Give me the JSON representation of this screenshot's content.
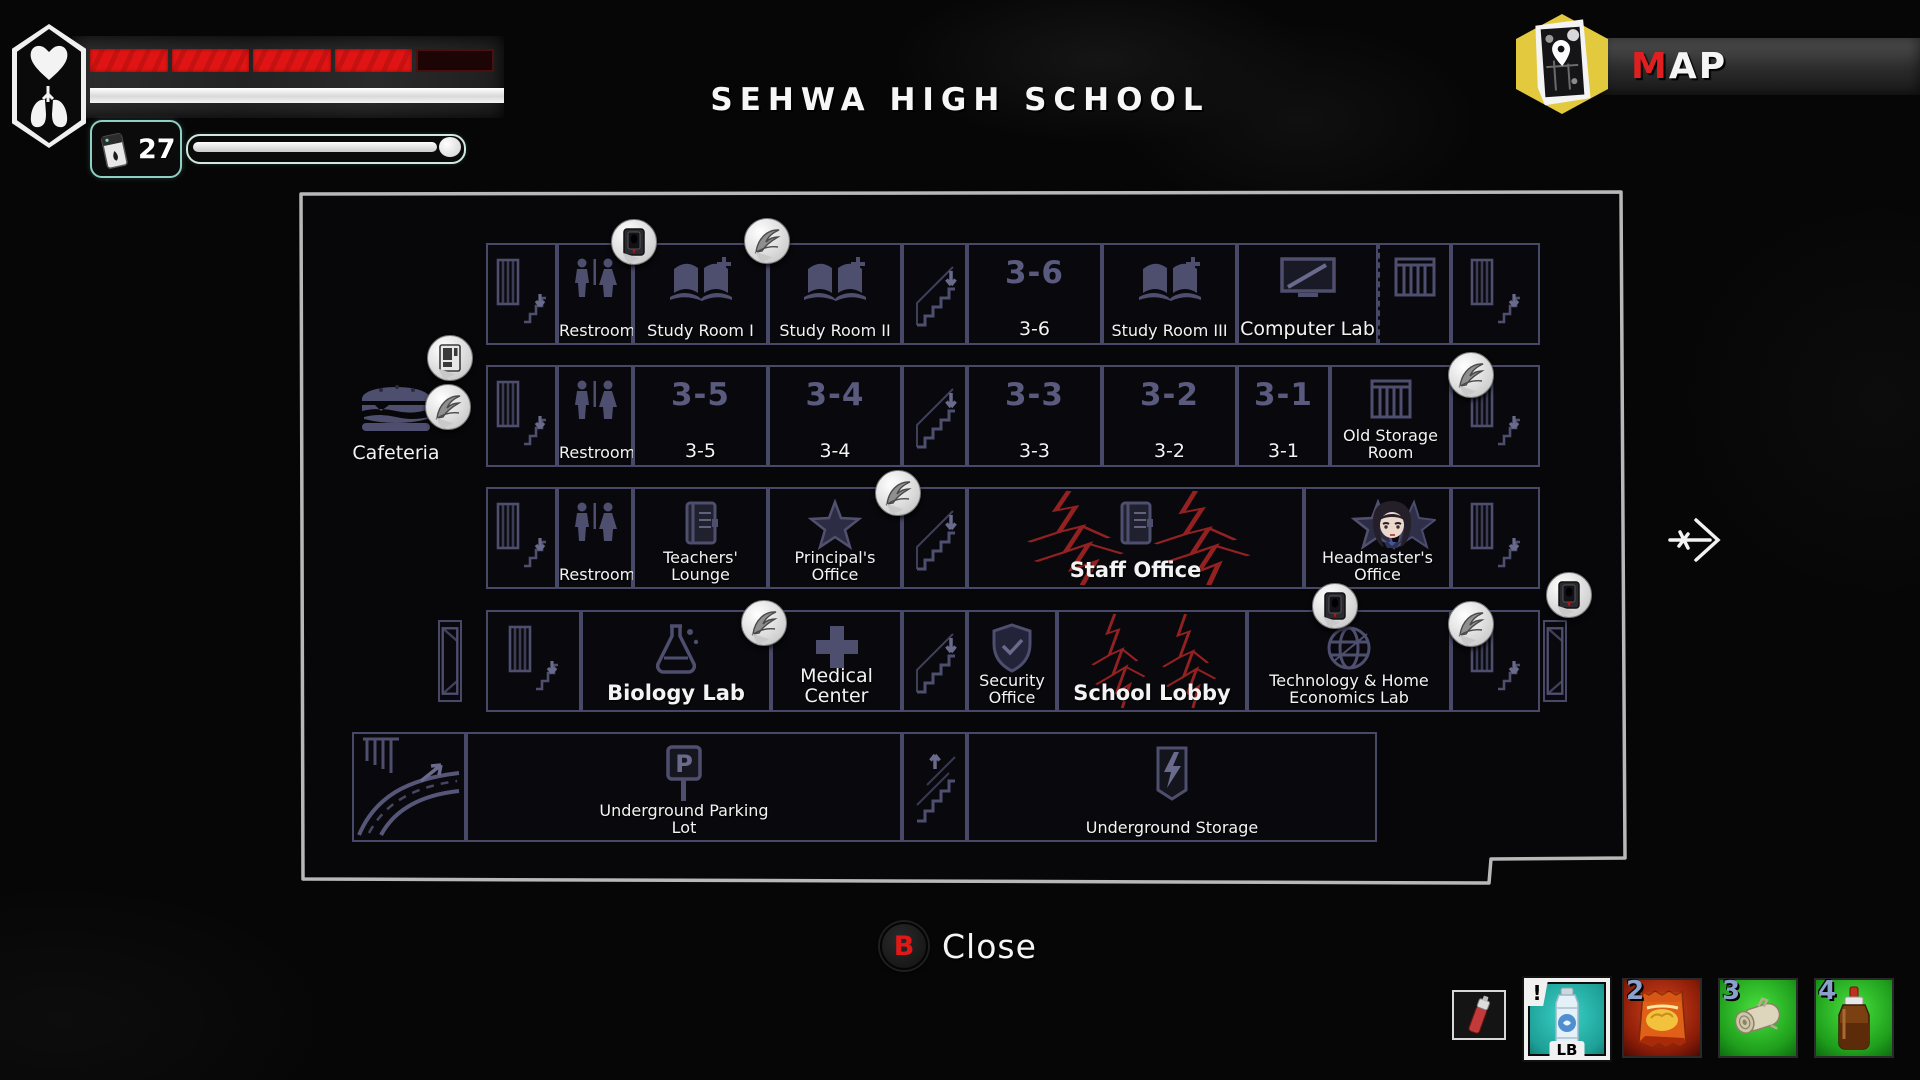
{
  "colors": {
    "health_red": "#e01414",
    "accent_red": "#e02020",
    "room_outline": "#484868",
    "icon_ink": "#4e4e6e",
    "crack_red": "#9c2323",
    "hex_yellow": "#e3c93e",
    "selected_teal": "#2fc4ba"
  },
  "hud": {
    "health": {
      "segments_total": 5,
      "segments_filled": 4
    },
    "stamina_full": true,
    "lighter_count": "27",
    "icons": [
      "heart-icon",
      "lungs-icon",
      "lighter-icon",
      "match-meter"
    ]
  },
  "header": {
    "title": "SEHWA HIGH SCHOOL",
    "map_badge": {
      "accent": "M",
      "rest": "AP",
      "icon": "map-icon"
    }
  },
  "map": {
    "floors": [
      {
        "name": "floor-top",
        "y": 243,
        "h": 102,
        "rooms": [
          {
            "id": "stairwell-nw",
            "icon": "door-stairs",
            "x": 486,
            "w": 71
          },
          {
            "id": "restroom-3f",
            "icon": "restroom",
            "label": "Restroom",
            "x": 557,
            "w": 76
          },
          {
            "id": "study-room-1",
            "icon": "book-plus",
            "label": "Study Room I",
            "x": 633,
            "w": 135
          },
          {
            "id": "study-room-2",
            "icon": "book-plus",
            "label": "Study Room II",
            "x": 768,
            "w": 134
          },
          {
            "id": "stairs-mid-top",
            "icon": "stairs-down",
            "x": 902,
            "w": 65
          },
          {
            "id": "classroom-3-6",
            "number": "3-6",
            "label": "3-6",
            "label_size": "md",
            "x": 967,
            "w": 135
          },
          {
            "id": "study-room-3",
            "icon": "book-plus",
            "label": "Study Room III",
            "x": 1102,
            "w": 135
          },
          {
            "id": "computer-lab",
            "icon": "monitor",
            "label": "Computer Lab",
            "label_size": "md",
            "x": 1237,
            "w": 141
          },
          {
            "id": "shelf-nook",
            "icon": "shelf",
            "dashed": true,
            "x": 1378,
            "w": 73
          },
          {
            "id": "stairwell-ne",
            "icon": "door-stairs",
            "x": 1451,
            "w": 89
          }
        ]
      },
      {
        "name": "floor-2",
        "y": 365,
        "h": 102,
        "rooms": [
          {
            "id": "cafeteria",
            "icon": "burger",
            "label": "Cafeteria",
            "label_size": "md",
            "outside": true,
            "x": 332,
            "w": 128
          },
          {
            "id": "stairwell-w2",
            "icon": "door-stairs",
            "x": 486,
            "w": 71
          },
          {
            "id": "restroom-2f",
            "icon": "restroom",
            "label": "Restroom",
            "x": 557,
            "w": 76
          },
          {
            "id": "classroom-3-5",
            "number": "3-5",
            "label": "3-5",
            "label_size": "md",
            "x": 633,
            "w": 135
          },
          {
            "id": "classroom-3-4",
            "number": "3-4",
            "label": "3-4",
            "label_size": "md",
            "x": 768,
            "w": 134
          },
          {
            "id": "stairs-mid-2",
            "icon": "stairs-down",
            "x": 902,
            "w": 65
          },
          {
            "id": "classroom-3-3",
            "number": "3-3",
            "label": "3-3",
            "label_size": "md",
            "x": 967,
            "w": 135
          },
          {
            "id": "classroom-3-2",
            "number": "3-2",
            "label": "3-2",
            "label_size": "md",
            "x": 1102,
            "w": 135
          },
          {
            "id": "classroom-3-1",
            "number": "3-1",
            "label": "3-1",
            "label_size": "md",
            "x": 1237,
            "w": 93
          },
          {
            "id": "old-storage-room",
            "icon": "shelf",
            "label": "Old Storage\nRoom",
            "x": 1330,
            "w": 121
          },
          {
            "id": "stairwell-e2",
            "icon": "door-stairs",
            "x": 1451,
            "w": 89
          }
        ]
      },
      {
        "name": "floor-3",
        "y": 487,
        "h": 102,
        "rooms": [
          {
            "id": "stairwell-w3",
            "icon": "door-stairs",
            "x": 486,
            "w": 71
          },
          {
            "id": "restroom-1f",
            "icon": "restroom",
            "label": "Restroom",
            "x": 557,
            "w": 76
          },
          {
            "id": "teachers-lounge",
            "icon": "journal",
            "label": "Teachers'\nLounge",
            "x": 633,
            "w": 135
          },
          {
            "id": "principals-office",
            "icon": "star",
            "label": "Principal's\nOffice",
            "x": 768,
            "w": 134
          },
          {
            "id": "stairs-mid-3",
            "icon": "stairs-down",
            "x": 902,
            "w": 65
          },
          {
            "id": "staff-office",
            "icon": "journal",
            "label": "Staff Office",
            "label_size": "lg",
            "cracks": true,
            "x": 967,
            "w": 337
          },
          {
            "id": "headmasters-office",
            "icon": "star",
            "label": "Headmaster's\nOffice",
            "portrait": true,
            "x": 1304,
            "w": 147
          },
          {
            "id": "stairwell-e3",
            "icon": "door-stairs",
            "x": 1451,
            "w": 89
          }
        ]
      },
      {
        "name": "floor-lobby",
        "y": 610,
        "h": 102,
        "rooms": [
          {
            "id": "door-west",
            "icon": "door-open",
            "x": 438,
            "w": 24,
            "dy": 10,
            "dh": -20
          },
          {
            "id": "stairwell-w4",
            "icon": "door-stairs",
            "x": 486,
            "w": 95
          },
          {
            "id": "biology-lab",
            "icon": "flask",
            "label": "Biology Lab",
            "label_size": "lg",
            "x": 581,
            "w": 190
          },
          {
            "id": "medical-center",
            "icon": "cross",
            "label": "Medical Center",
            "label_size": "md",
            "x": 771,
            "w": 131
          },
          {
            "id": "stairs-mid-4",
            "icon": "stairs-down",
            "x": 902,
            "w": 65
          },
          {
            "id": "security-office",
            "icon": "shield",
            "label": "Security\nOffice",
            "x": 967,
            "w": 90
          },
          {
            "id": "school-lobby",
            "label": "School Lobby",
            "label_size": "lg",
            "cracks": true,
            "x": 1057,
            "w": 190
          },
          {
            "id": "tech-home-econ-lab",
            "icon": "globe",
            "label": "Technology & Home\nEconomics Lab",
            "x": 1247,
            "w": 204
          },
          {
            "id": "stairwell-e4",
            "icon": "door-stairs",
            "x": 1451,
            "w": 89
          },
          {
            "id": "door-east",
            "icon": "door-open",
            "x": 1543,
            "w": 24,
            "dy": 10,
            "dh": -20
          }
        ]
      },
      {
        "name": "floor-basement",
        "y": 732,
        "h": 110,
        "rooms": [
          {
            "id": "parking-ramp",
            "icon": "ramp",
            "x": 352,
            "w": 114
          },
          {
            "id": "underground-parking-lot",
            "icon": "parking",
            "label": "Underground Parking\nLot",
            "x": 466,
            "w": 436
          },
          {
            "id": "stairs-mid-5",
            "icon": "stairs-up",
            "x": 902,
            "w": 65
          },
          {
            "id": "underground-storage",
            "icon": "bolt",
            "label": "Underground Storage",
            "x": 967,
            "w": 410
          }
        ]
      }
    ],
    "markers": [
      {
        "type": "document-marker",
        "x": 633,
        "y": 241
      },
      {
        "type": "feather-marker",
        "x": 766,
        "y": 240
      },
      {
        "type": "vending-machine-marker",
        "x": 449,
        "y": 357
      },
      {
        "type": "feather-marker",
        "x": 447,
        "y": 406
      },
      {
        "type": "feather-marker",
        "x": 1470,
        "y": 374
      },
      {
        "type": "feather-marker",
        "x": 897,
        "y": 492
      },
      {
        "type": "feather-marker",
        "x": 763,
        "y": 622
      },
      {
        "type": "document-marker",
        "x": 1334,
        "y": 605
      },
      {
        "type": "feather-marker",
        "x": 1470,
        "y": 623
      },
      {
        "type": "document-marker",
        "x": 1568,
        "y": 594
      }
    ],
    "player": {
      "x": 1366,
      "y": 498,
      "location": "Headmaster's Office"
    }
  },
  "footer": {
    "close_key": "B",
    "close_label": "Close"
  },
  "inventory": {
    "slots": [
      {
        "name": "flare-marker",
        "badge": "",
        "bg": "dark",
        "small": true
      },
      {
        "name": "water-bottle",
        "badge": "!",
        "hotkey": "LB",
        "selected": true,
        "bg": "teal"
      },
      {
        "name": "chips-bag",
        "badge": "2",
        "bg": "red"
      },
      {
        "name": "bandage-roll",
        "badge": "3",
        "bg": "green"
      },
      {
        "name": "medicine-bottle",
        "badge": "4",
        "bg": "green"
      }
    ]
  }
}
